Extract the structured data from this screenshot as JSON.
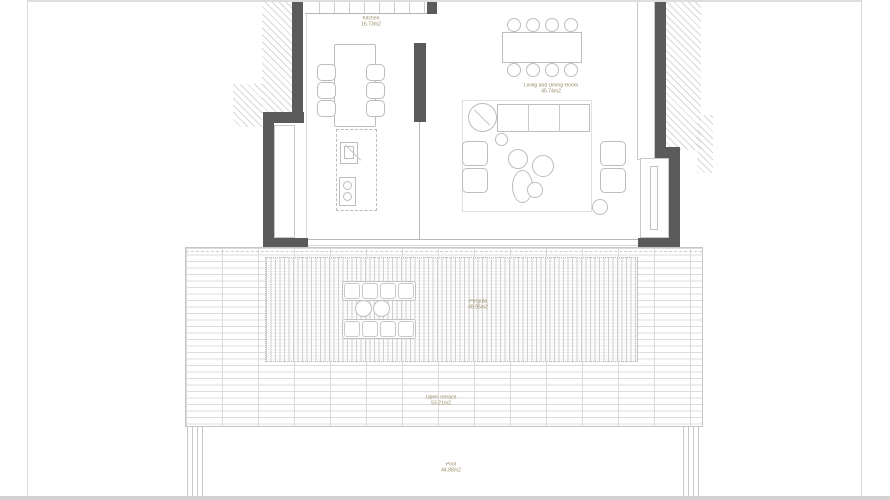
{
  "plan": {
    "rooms": {
      "kitchen": {
        "name": "Kitchen",
        "area": "16.73m2"
      },
      "living_dining": {
        "name": "Living and Dining Room",
        "area": "45.74m2"
      },
      "pergola": {
        "name": "Pergola",
        "area": "49.95m2"
      },
      "open_terrace": {
        "name": "Open Terrace",
        "area": "53.21m2"
      },
      "pool": {
        "name": "Pool",
        "area": "44.88m2"
      }
    },
    "colors": {
      "wall": "#5b5b5b",
      "label_text": "#9a8a68",
      "furniture_line": "#bdbdbd",
      "deck_line": "#dcdcdc"
    }
  }
}
